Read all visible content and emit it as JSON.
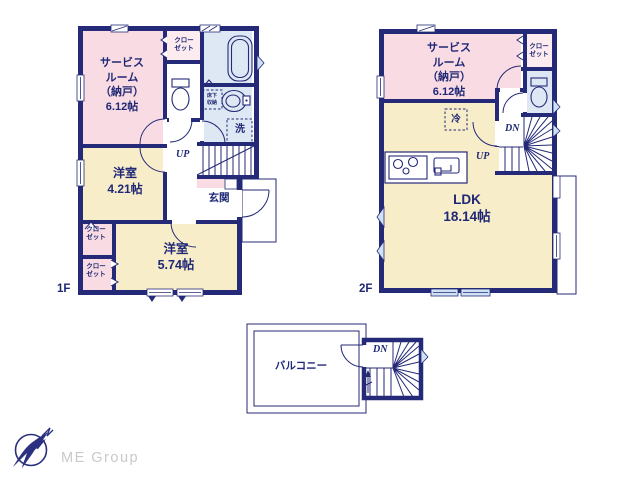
{
  "colors": {
    "wall_navy": "#252a78",
    "text_navy": "#1f2876",
    "room_pink": "#f9dce3",
    "room_pink_light": "#fcebef",
    "room_cream": "#f8edc9",
    "room_blue": "#dde8f4",
    "window_blue": "#cfe2f4",
    "logo_gray": "#c9c9c9"
  },
  "floor1": {
    "floor_label": "1F",
    "service_room": "サービス\nルーム\n（納戸）\n6.12帖",
    "closet_top": "クロー\nゼット",
    "underfloor_storage": "床下\n収納",
    "washer": "洗",
    "stairs_up": "UP",
    "bedroom_small": "洋室\n4.21帖",
    "entrance": "玄関",
    "closet_left_upper": "クロー\nゼット",
    "closet_left_lower": "クロー\nゼット",
    "bedroom_large": "洋室\n5.74帖"
  },
  "floor2": {
    "floor_label": "2F",
    "service_room": "サービス\nルーム\n（納戸）\n6.12帖",
    "closet": "クロー\nゼット",
    "refrigerator": "冷",
    "stairs_down": "DN",
    "stairs_up": "UP",
    "ldk": "LDK\n18.14帖"
  },
  "roof": {
    "balcony": "バルコニー",
    "stairs_down": "DN"
  },
  "logo": {
    "company": "ME Group"
  }
}
